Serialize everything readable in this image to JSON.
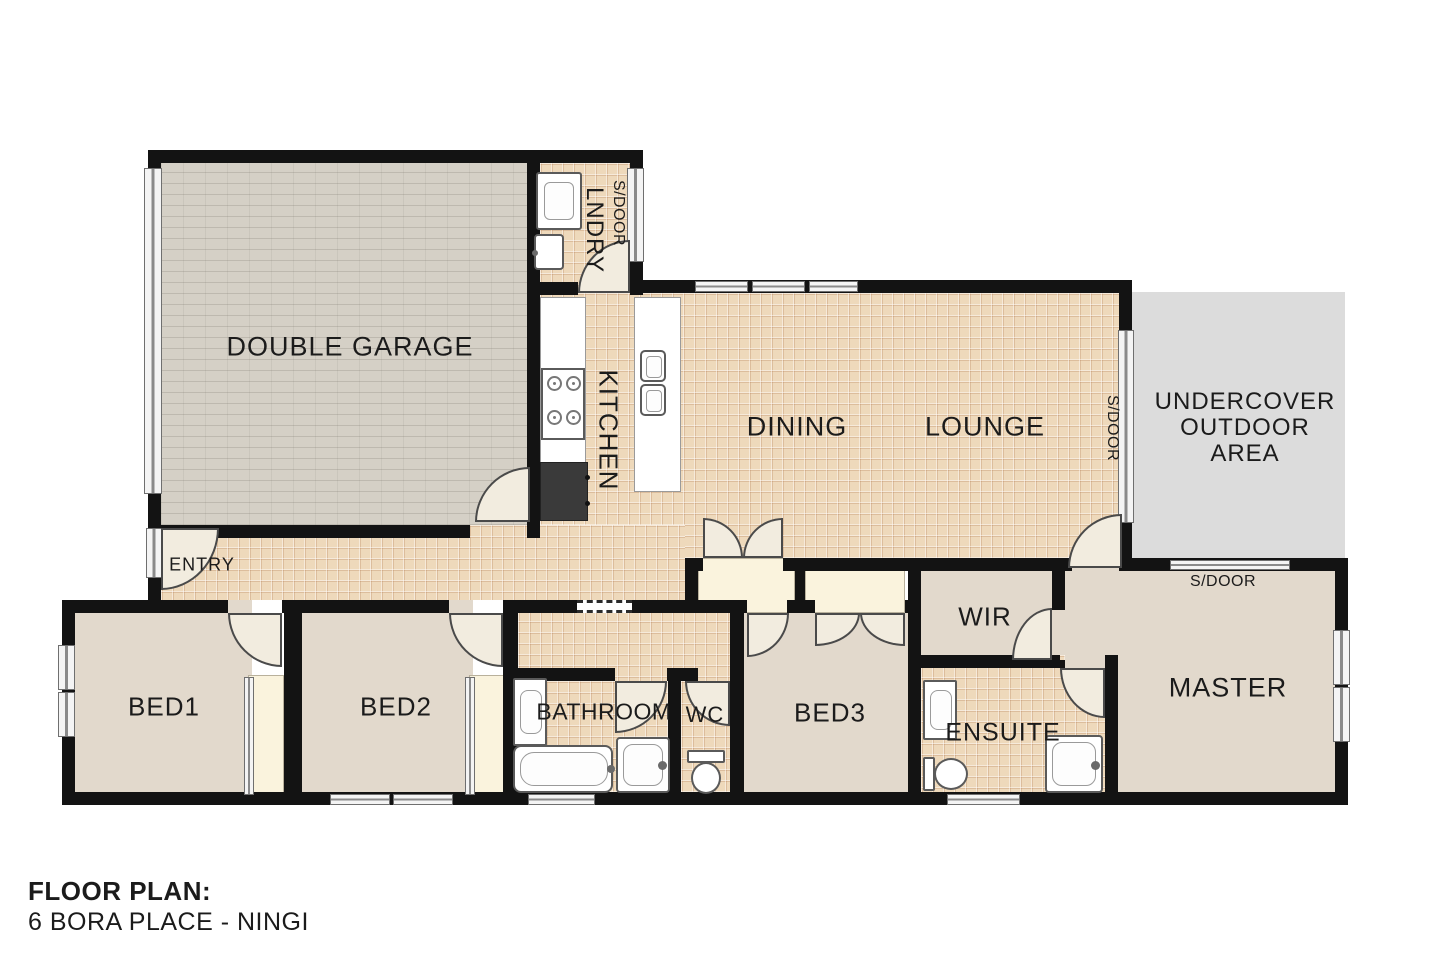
{
  "meta": {
    "floorplan_label": "FLOOR PLAN:",
    "address": "6 BORA PLACE - NINGI"
  },
  "rooms": {
    "garage": "DOUBLE GARAGE",
    "laundry": "LNDRY",
    "kitchen": "KITCHEN",
    "dining": "DINING",
    "lounge": "LOUNGE",
    "outdoor_lines": [
      "UNDERCOVER",
      "OUTDOOR",
      "AREA"
    ],
    "entry": "ENTRY",
    "bed1": "BED1",
    "bed2": "BED2",
    "bed3": "BED3",
    "bathroom": "BATHROOM",
    "wc": "WC",
    "wir": "WIR",
    "ensuite": "ENSUITE",
    "master": "MASTER"
  },
  "doors": {
    "sliding_laundry": "S/DOOR",
    "sliding_lounge": "S/DOOR",
    "sliding_master": "S/DOOR"
  },
  "colors": {
    "wall": "#131313",
    "tile_floor": "#eed9bb",
    "garage_floor": "#d5d0c6",
    "bedroom_floor": "#e2d9cc",
    "outdoor_floor": "#dcdcdc",
    "cupboard": "#faf3dd"
  }
}
